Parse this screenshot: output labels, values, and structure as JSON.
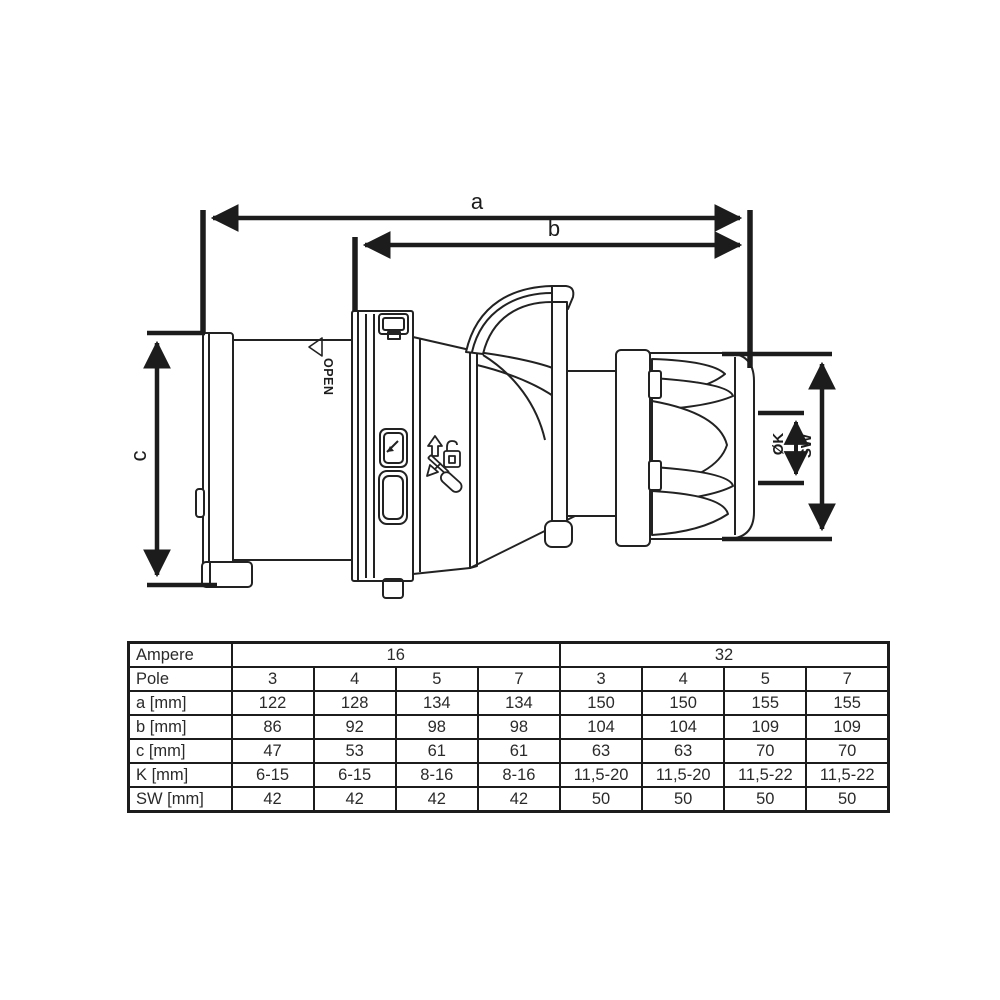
{
  "drawing": {
    "dim_a": "a",
    "dim_b": "b",
    "dim_c": "c",
    "dim_k": "ØK",
    "dim_sw": "SW",
    "open_marking": "OPEN",
    "line_color": "#1c1c1c"
  },
  "table": {
    "header": {
      "ampere_label": "Ampere",
      "amp16": "16",
      "amp32": "32"
    },
    "pole": {
      "label": "Pole",
      "values": [
        "3",
        "4",
        "5",
        "7",
        "3",
        "4",
        "5",
        "7"
      ]
    },
    "rows": [
      {
        "label": "a [mm]",
        "values": [
          "122",
          "128",
          "134",
          "134",
          "150",
          "150",
          "155",
          "155"
        ]
      },
      {
        "label": "b [mm]",
        "values": [
          "86",
          "92",
          "98",
          "98",
          "104",
          "104",
          "109",
          "109"
        ]
      },
      {
        "label": "c [mm]",
        "values": [
          "47",
          "53",
          "61",
          "61",
          "63",
          "63",
          "70",
          "70"
        ]
      },
      {
        "label": "K [mm]",
        "values": [
          "6-15",
          "6-15",
          "8-16",
          "8-16",
          "11,5-20",
          "11,5-20",
          "11,5-22",
          "11,5-22"
        ]
      },
      {
        "label": "SW [mm]",
        "values": [
          "42",
          "42",
          "42",
          "42",
          "50",
          "50",
          "50",
          "50"
        ]
      }
    ]
  }
}
